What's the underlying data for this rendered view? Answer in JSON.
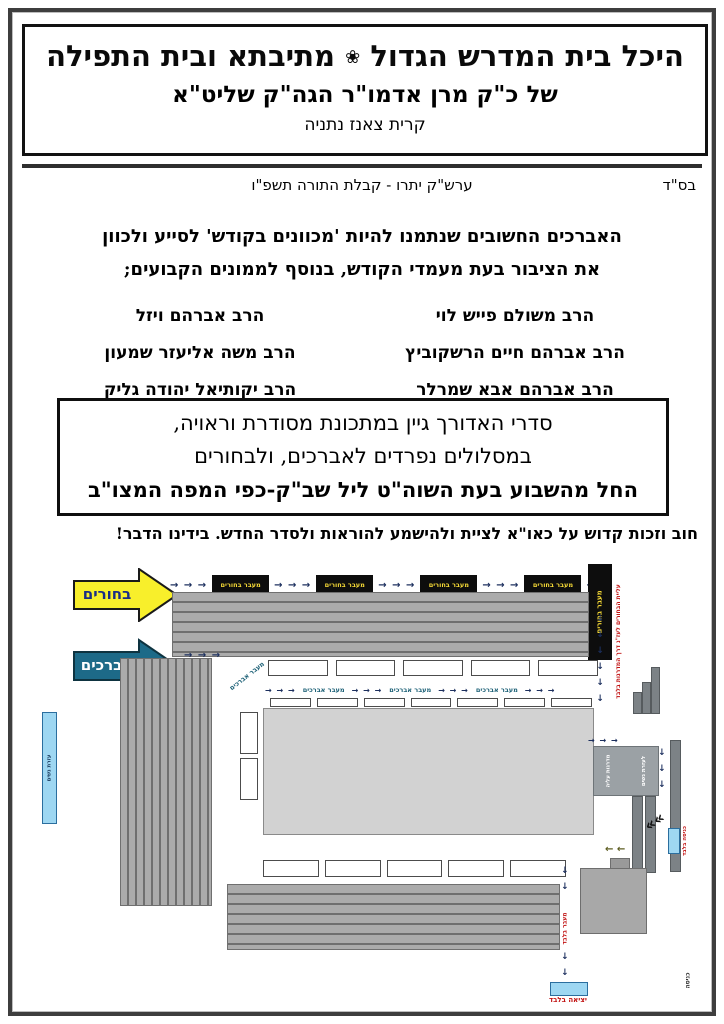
{
  "header": {
    "bsd": "בס\"ד",
    "date_line": "ערש\"ק יתרו - קבלת התורה תשפ\"ו",
    "title_right": "היכל בית המדרש הגדול",
    "flower": "❀",
    "title_left": "מתיבתא ובית התפילה",
    "subtitle": "של כ\"ק מרן אדמו\"ר הגה\"ק שליט\"א",
    "location": "קרית צאנז נתניה"
  },
  "intro": {
    "line1": "האברכים החשובים שנתמנו להיות 'מכוונים בקודש' לסייע ולכוון",
    "line2": "את הציבור בעת מעמדי הקודש, בנוסף לממונים הקבועים;"
  },
  "names": {
    "right": [
      "הרב משולם פייש לוי",
      "הרב אברהם חיים הרשקוביץ",
      "הרב אברהם אבא שמרלר"
    ],
    "left": [
      "הרב אברהם ויזל",
      "הרב משה אליעזר שמעון",
      "הרב יקותיאל יהודה גליק"
    ]
  },
  "notice_box": {
    "line1": "סדרי האדורך גיין במתכונת מסודרת וראויה,",
    "line2": "במסלולים נפרדים לאברכים, ולבחורים",
    "line3": "החל מהשבוע בעת השוה\"ט ליל שב\"ק-כפי המפה המצו\"ב"
  },
  "call_line": {
    "text": "חוב וזכות קדוש על כאו\"א לציית ולהישמע להוראות ולסדר החדש.",
    "emphasis": "בידינו הדבר!"
  },
  "diagram": {
    "arrow_bochurim": "בחורים",
    "arrow_avreichim": "אברכים",
    "passage_bochurim": "מעבר בחורים",
    "passage_avreichim": "מעבר אברכים",
    "stairs_line1": "מדרגות עליה",
    "stairs_line2": "לעזרת נשים",
    "women_bar": "עזרת נשים",
    "note_top_red": "עליית הבחורים לעז\"נ דרך המדרגות בלבד",
    "note_entry_only": "כניסה בלבד",
    "note_passage_only": "מעבר בלבד",
    "note_exit_only": "יציאה בלבד",
    "note_entrance": "כניסה"
  },
  "icons": {
    "arrow_right": "→",
    "arrows_right_3": "→ → →",
    "arrows_right_2": "→ →",
    "arrow_down": "↓",
    "arrows_left_2": "← ←",
    "chevron_turn": "««"
  },
  "colors": {
    "accent_yellow": "#f8ef2b",
    "accent_teal": "#1d6a88",
    "passage_black": "#0d0d0d",
    "passage_text": "#f5d936",
    "note_red": "#c11212",
    "route_navy": "#1c2f5e",
    "door_blue": "#9ed7f2"
  }
}
